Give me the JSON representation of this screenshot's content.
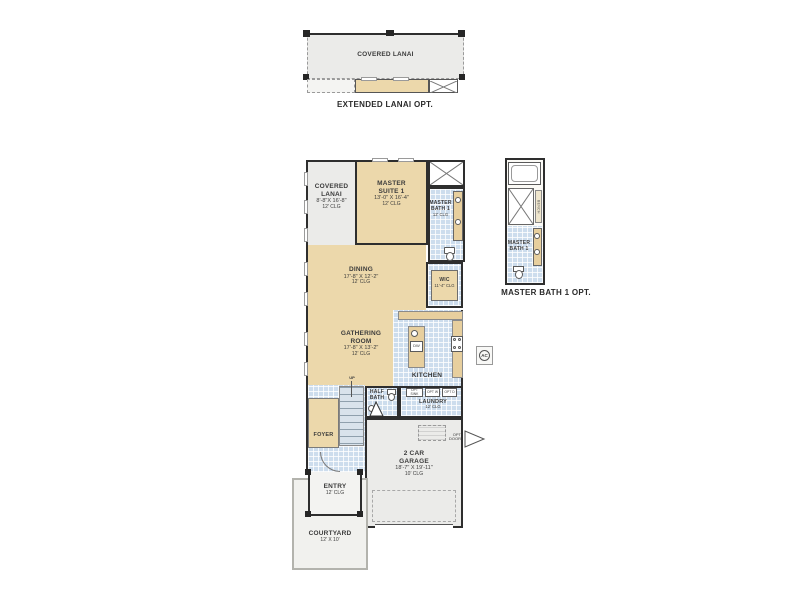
{
  "meta": {
    "title": "Floor plan"
  },
  "colors": {
    "tan": "#ecd8ab",
    "tile_blue": "#cddded",
    "gray": "#ebebe9",
    "wall": "#2e2e2e"
  },
  "extended_lanai": {
    "deck_label": "COVERED LANAI",
    "caption": "EXTENDED LANAI OPT."
  },
  "rooms": {
    "covered_lanai": {
      "name": "COVERED LANAI",
      "dims": "8'-8\"X 16'-8\"",
      "clg": "12' CLG"
    },
    "master_suite": {
      "name": "MASTER SUITE 1",
      "dims": "13'-0\" X 16'-4\"",
      "clg": "12' CLG"
    },
    "master_bath": {
      "name": "MASTER BATH 1",
      "clg": "12' CLG"
    },
    "wic": {
      "name": "WIC",
      "clg": "11'-4\" CLG"
    },
    "dining": {
      "name": "DINING",
      "dims": "17'-8\" X 12'-2\"",
      "clg": "12' CLG"
    },
    "gathering_room": {
      "name": "GATHERING ROOM",
      "dims": "17'-8\" X 13'-2\"",
      "clg": "12' CLG"
    },
    "kitchen": {
      "name": "KITCHEN"
    },
    "half_bath": {
      "name": "HALF BATH"
    },
    "laundry": {
      "name": "LAUNDRY",
      "clg": "12' CLG"
    },
    "foyer": {
      "name": "FOYER"
    },
    "entry": {
      "name": "ENTRY",
      "clg": "12' CLG"
    },
    "garage": {
      "name": "2 CAR GARAGE",
      "dims": "18'-7\" X 19'-11\"",
      "clg": "10' CLG"
    },
    "courtyard": {
      "name": "COURTYARD",
      "dims": "12' X 10'"
    }
  },
  "master_bath_opt": {
    "room_label": "MASTER BATH 1",
    "caption": "MASTER BATH 1 OPT.",
    "bench": "BENCH"
  },
  "annotations": {
    "up": "UP",
    "dw": "DW",
    "opt_ref": "OPT REF",
    "opt_sink": "OPT SINK",
    "opt_w": "OPT W",
    "opt_d": "OPT D",
    "opt_door": "OPT DOOR",
    "ac": "AC"
  }
}
